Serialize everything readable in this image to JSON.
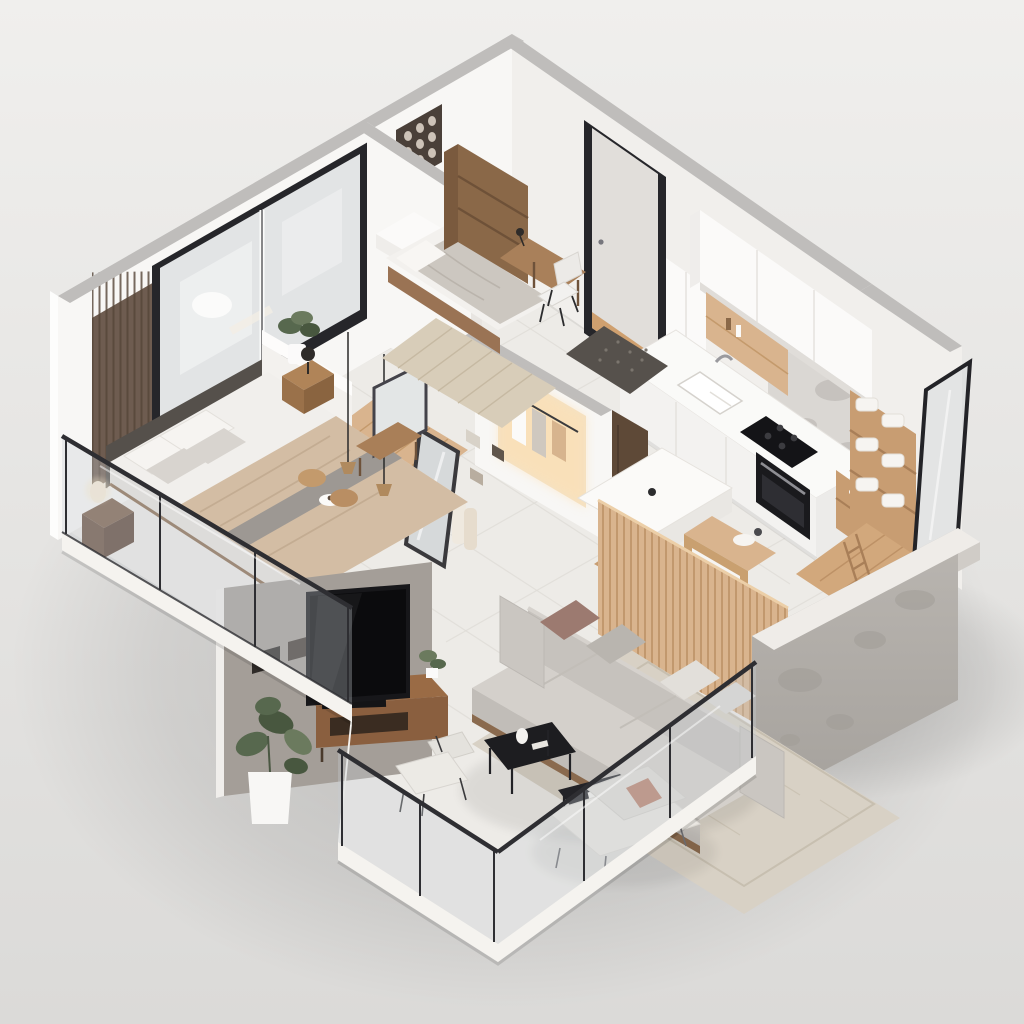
{
  "scene": {
    "description": "Photorealistic isometric 3D cutaway floor-plan render of a modern one-bedroom apartment with balcony",
    "projection": "isometric bird's-eye cutaway",
    "no_visible_text": true
  },
  "palette": {
    "bg_top": "#f0efed",
    "bg_bottom": "#dbdad8",
    "wall_white": "#f8f7f5",
    "wall_shade": "#f1efec",
    "wall_top": "#bfbdbb",
    "wall_outer": "#fdfdfc",
    "floor": "#edebe7",
    "tile_line": "#dfdcd7",
    "slab": "#f5f3ef",
    "frame_black": "#26262a",
    "window_glass": "#eef0f1",
    "slat_wall": "#6e5c50",
    "wood": "#a97f58",
    "wood_light": "#d9b48e",
    "wood_mid": "#c89d72",
    "wood_dark": "#8a6848",
    "console_wood": "#8a5f3f",
    "glass": "rgba(198,206,211,0.32)",
    "glass_rail_frame": "#2e2e32",
    "concrete": "#b5b1ac",
    "concrete_top": "#efece8",
    "taupe_wall": "#a49e98",
    "sofa": "#c6c2bd",
    "sofa_seat": "#d4d0cb",
    "sofa_front": "#c1bdb8",
    "pillow_mauve": "#9c7a70",
    "pillow_gray": "#b9b5af",
    "pillow_light": "#e2dfda",
    "bed_blanket": "#d3bda4",
    "bedding_white": "#f1efec",
    "throw_gray": "#9d9893",
    "headboard": "#55504b",
    "rug_living": "#d8d1c5",
    "rug_bedroom": "#d8cdb9",
    "rug_runner": "#cfc5b5",
    "doormat": "#56514c",
    "tv_screen": "#0b0b0d",
    "table_black": "#1d1d20",
    "plant": "#57684e",
    "plant_light": "#6b7a5e",
    "towel": "#f6f4f1",
    "niche": "#f3e2c6",
    "niche_glow": "#ffdfae",
    "cabinet": "#fbfaf9",
    "counter": "#fafaf8",
    "oven": "#1a1a1d",
    "steel": "#9a9a9e",
    "bath_floor": "#d2a87c",
    "marble": "#cbc7c3"
  },
  "rooms": [
    {
      "id": "master-bedroom",
      "objects": [
        "double-bed",
        "headboard-panel",
        "nightstands",
        "table-lamps",
        "pendant-lamps",
        "sliding-window",
        "wood-slat-accent-wall",
        "vanity-desk",
        "stools",
        "leaning-mirror",
        "ledge-plant"
      ]
    },
    {
      "id": "second-bedroom",
      "objects": [
        "single-bed",
        "desk",
        "desk-chair",
        "bookshelf",
        "wall-art-panel",
        "area-rug"
      ]
    },
    {
      "id": "entry",
      "objects": [
        "glass-entry-door",
        "doormat",
        "runner-rug"
      ]
    },
    {
      "id": "hallway",
      "objects": [
        "lit-wardrobe-niche",
        "hanging-clothes",
        "wardrobe-door",
        "hanging-towels",
        "wood-flooring",
        "leaning-mirror"
      ]
    },
    {
      "id": "kitchen",
      "objects": [
        "upper-cabinets",
        "tall-cabinet",
        "wood-backsplash-niche",
        "countertop",
        "sink",
        "faucet",
        "cooktop",
        "oven",
        "open-shelf",
        "marble-wall"
      ]
    },
    {
      "id": "dining",
      "objects": [
        "white-island-table",
        "wood-slat-partition",
        "serving-cart",
        "wood-stool"
      ]
    },
    {
      "id": "bathroom",
      "objects": [
        "glass-partition",
        "towel-shelf",
        "towel-ladder",
        "toilet",
        "wood-floor"
      ]
    },
    {
      "id": "living-room",
      "objects": [
        "sofa",
        "throw-pillows",
        "coffee-tables",
        "area-rug",
        "tv",
        "tv-console",
        "soundbar",
        "plants",
        "taupe-tv-wall"
      ]
    },
    {
      "id": "balcony",
      "objects": [
        "glass-railing",
        "lounge-chaise",
        "wire-chair",
        "white-planter"
      ]
    },
    {
      "id": "structure",
      "objects": [
        "white-walls",
        "concrete-wall",
        "floor-slab",
        "tile-floor"
      ]
    }
  ]
}
